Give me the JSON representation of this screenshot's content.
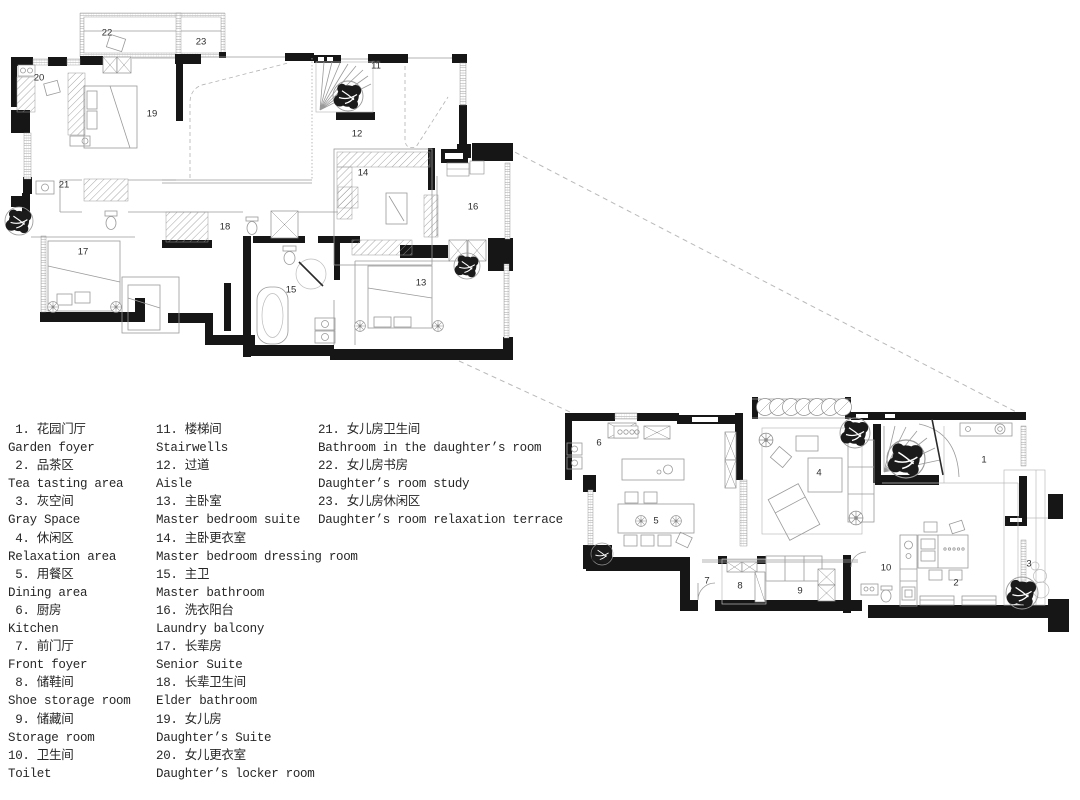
{
  "legend": {
    "columns": [
      [
        {
          "num": "1",
          "zh": "花园门厅",
          "en": "Garden foyer"
        },
        {
          "num": "2",
          "zh": "品茶区",
          "en": "Tea tasting area"
        },
        {
          "num": "3",
          "zh": "灰空间",
          "en": "Gray Space"
        },
        {
          "num": "4",
          "zh": "休闲区",
          "en": "Relaxation area"
        },
        {
          "num": "5",
          "zh": "用餐区",
          "en": "Dining area"
        },
        {
          "num": "6",
          "zh": "厨房",
          "en": "Kitchen"
        },
        {
          "num": "7",
          "zh": "前门厅",
          "en": "Front foyer"
        },
        {
          "num": "8",
          "zh": "储鞋间",
          "en": "Shoe storage room"
        },
        {
          "num": "9",
          "zh": "储藏间",
          "en": "Storage room"
        },
        {
          "num": "10",
          "zh": "卫生间",
          "en": "Toilet"
        }
      ],
      [
        {
          "num": "11",
          "zh": "楼梯间",
          "en": "Stairwells"
        },
        {
          "num": "12",
          "zh": "过道",
          "en": "Aisle"
        },
        {
          "num": "13",
          "zh": "主卧室",
          "en": "Master bedroom suite"
        },
        {
          "num": "14",
          "zh": "主卧更衣室",
          "en": "Master bedroom dressing room"
        },
        {
          "num": "15",
          "zh": "主卫",
          "en": "Master bathroom"
        },
        {
          "num": "16",
          "zh": "洗衣阳台",
          "en": "Laundry balcony"
        },
        {
          "num": "17",
          "zh": "长辈房",
          "en": "Senior Suite"
        },
        {
          "num": "18",
          "zh": "长辈卫生间",
          "en": "Elder bathroom"
        },
        {
          "num": "19",
          "zh": "女儿房",
          "en": "Daughter’s Suite"
        },
        {
          "num": "20",
          "zh": "女儿更衣室",
          "en": "Daughter’s locker room"
        }
      ],
      [
        {
          "num": "21",
          "zh": "女儿房卫生间",
          "en": "Bathroom in the daughter’s room"
        },
        {
          "num": "22",
          "zh": "女儿房书房",
          "en": "Daughter’s room study"
        },
        {
          "num": "23",
          "zh": "女儿房休闲区",
          "en": "Daughter’s room relaxation terrace"
        }
      ]
    ]
  },
  "plans": {
    "upper": {
      "room_labels": [
        {
          "n": "20",
          "x": 39,
          "y": 78
        },
        {
          "n": "22",
          "x": 107,
          "y": 33
        },
        {
          "n": "23",
          "x": 201,
          "y": 42
        },
        {
          "n": "19",
          "x": 152,
          "y": 114
        },
        {
          "n": "21",
          "x": 64,
          "y": 185
        },
        {
          "n": "11",
          "x": 376,
          "y": 66
        },
        {
          "n": "12",
          "x": 357,
          "y": 134
        },
        {
          "n": "14",
          "x": 363,
          "y": 173
        },
        {
          "n": "16",
          "x": 473,
          "y": 207
        },
        {
          "n": "18",
          "x": 225,
          "y": 227
        },
        {
          "n": "15",
          "x": 291,
          "y": 290
        },
        {
          "n": "17",
          "x": 83,
          "y": 252
        },
        {
          "n": "13",
          "x": 421,
          "y": 283
        }
      ]
    },
    "lower": {
      "room_labels": [
        {
          "n": "6",
          "x": 599,
          "y": 443
        },
        {
          "n": "5",
          "x": 656,
          "y": 521
        },
        {
          "n": "4",
          "x": 819,
          "y": 473
        },
        {
          "n": "7",
          "x": 707,
          "y": 581
        },
        {
          "n": "8",
          "x": 740,
          "y": 586
        },
        {
          "n": "9",
          "x": 800,
          "y": 591
        },
        {
          "n": "10",
          "x": 886,
          "y": 568
        },
        {
          "n": "2",
          "x": 956,
          "y": 583
        },
        {
          "n": "1",
          "x": 984,
          "y": 460
        },
        {
          "n": "3",
          "x": 1029,
          "y": 564
        }
      ]
    }
  },
  "colors": {
    "wall": "#161616",
    "furniture_line": "#9a9a9a",
    "dashed": "#b9b9b9",
    "text": "#272727"
  }
}
